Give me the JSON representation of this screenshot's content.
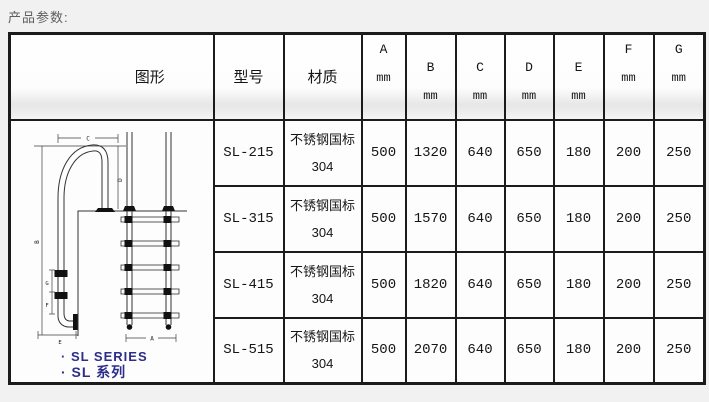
{
  "page": {
    "title": "产品参数:"
  },
  "table": {
    "headers": {
      "figure": "图形",
      "model": "型号",
      "material": "材质",
      "dims": [
        {
          "letter": "A",
          "unit": "mm"
        },
        {
          "letter": "B",
          "unit": "mm"
        },
        {
          "letter": "C",
          "unit": "mm"
        },
        {
          "letter": "D",
          "unit": "mm"
        },
        {
          "letter": "E",
          "unit": "mm"
        },
        {
          "letter": "F",
          "unit": "mm"
        },
        {
          "letter": "G",
          "unit": "mm"
        }
      ]
    },
    "rows": [
      {
        "model": "SL-215",
        "material": [
          "不锈钢国标",
          "304"
        ],
        "values": [
          "500",
          "1320",
          "640",
          "650",
          "180",
          "200",
          "250"
        ]
      },
      {
        "model": "SL-315",
        "material": [
          "不锈钢国标",
          "304"
        ],
        "values": [
          "500",
          "1570",
          "640",
          "650",
          "180",
          "200",
          "250"
        ]
      },
      {
        "model": "SL-415",
        "material": [
          "不锈钢国标",
          "304"
        ],
        "values": [
          "500",
          "1820",
          "640",
          "650",
          "180",
          "200",
          "250"
        ]
      },
      {
        "model": "SL-515",
        "material": [
          "不锈钢国标",
          "304"
        ],
        "values": [
          "500",
          "2070",
          "640",
          "650",
          "180",
          "200",
          "250"
        ]
      }
    ]
  },
  "figure": {
    "series_label_en": "· SL SERIES",
    "series_label_zh": "· SL 系列",
    "accent_color": "#2d2d8a",
    "dim_labels": {
      "a": "A",
      "b": "B",
      "c": "C",
      "d": "D",
      "e": "E",
      "f": "F",
      "g": "G"
    }
  }
}
